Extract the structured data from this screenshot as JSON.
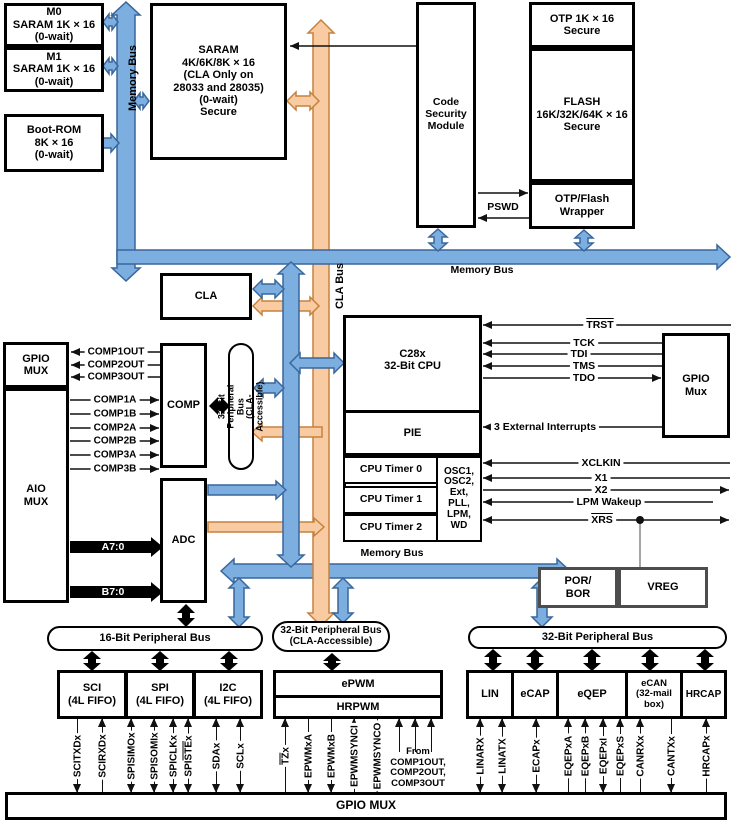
{
  "colors": {
    "bus_blue": "#7CAEE0",
    "bus_blue_border": "#39679C",
    "bus_orange": "#F8CBA2",
    "bus_orange_border": "#C5813E",
    "black": "#000000",
    "line": "#111111",
    "gray_line": "#808080"
  },
  "buses": {
    "memory_bus_vertical": "Memory Bus",
    "memory_bus_top": "Memory Bus",
    "memory_bus_mid": "Memory Bus",
    "cla_bus": "CLA Bus"
  },
  "ovals": {
    "p16": "16-Bit Peripheral Bus",
    "p32cla": "32-Bit Peripheral Bus\n(CLA-Accessible)",
    "p32": "32-Bit Peripheral Bus",
    "p32cla_vert": "32-Bit Peripheral Bus\n(CLA-Accessible)"
  },
  "boxes": {
    "m0": "M0\nSARAM 1K × 16\n(0-wait)",
    "m1": "M1\nSARAM 1K × 16\n(0-wait)",
    "boot_rom": "Boot-ROM\n8K × 16\n(0-wait)",
    "saram": "SARAM\n4K/6K/8K × 16\n(CLA Only on\n28033 and 28035)\n(0-wait)\nSecure",
    "csm": "Code\nSecurity\nModule",
    "otp": "OTP 1K × 16\nSecure",
    "flash": "FLASH\n16K/32K/64K × 16\nSecure",
    "wrapper": "OTP/Flash\nWrapper",
    "cla": "CLA",
    "gpio_mux_left": "GPIO\nMUX",
    "aio_mux": "AIO\nMUX",
    "comp": "COMP",
    "adc": "ADC",
    "cpu": "C28x\n32-Bit CPU",
    "pie": "PIE",
    "timer0": "CPU Timer 0",
    "timer1": "CPU Timer 1",
    "timer2": "CPU Timer 2",
    "osc": "OSC1,\nOSC2,\nExt,\nPLL,\nLPM,\nWD",
    "gpio_mux_right": "GPIO\nMux",
    "por_bor": "POR/\nBOR",
    "vreg": "VREG",
    "sci": "SCI\n(4L FIFO)",
    "spi": "SPI\n(4L FIFO)",
    "i2c": "I2C\n(4L FIFO)",
    "epwm": "ePWM",
    "hrpwm": "HRPWM",
    "lin": "LIN",
    "ecap": "eCAP",
    "eqep": "eQEP",
    "ecan": "eCAN\n(32-mail\nbox)",
    "hrcap": "HRCAP",
    "gpio_mux_bottom": "GPIO MUX"
  },
  "signals": {
    "trst": "[TRST]",
    "tck": "TCK",
    "tdi": "TDI",
    "tms": "TMS",
    "tdo": "TDO",
    "ext_int": "3 External Interrupts",
    "xclkin": "XCLKIN",
    "x1": "X1",
    "x2": "X2",
    "lpm_wakeup": "LPM Wakeup",
    "xrs": "[XRS]",
    "pswd": "PSWD"
  },
  "comp_outputs": [
    "COMP1OUT",
    "COMP2OUT",
    "COMP3OUT"
  ],
  "comp_inputs": [
    "COMP1A",
    "COMP1B",
    "COMP2A",
    "COMP2B",
    "COMP3A",
    "COMP3B"
  ],
  "adc_inputs": [
    "A7:0",
    "B7:0"
  ],
  "pins_left": [
    "SCITXDx",
    "SCIRXDx",
    "SPISIMOx",
    "SPISOMIx",
    "SPICLKx",
    "SPI[STE]x",
    "SDAx",
    "SCLx"
  ],
  "pins_middle": [
    "[TZ]x",
    "EPWMxA",
    "EPWMxB",
    "EPWMSYNCI",
    "EPWMSYNCO"
  ],
  "pins_right": [
    "LINARX",
    "LINATX",
    "ECAPx",
    "EQEPxA",
    "EQEPxB",
    "EQEPxI",
    "EQEPxS",
    "CANRXx",
    "CANTXx",
    "HRCAPx"
  ],
  "from_comp_label": "From\nCOMP1OUT,\nCOMP2OUT,\nCOMP3OUT"
}
